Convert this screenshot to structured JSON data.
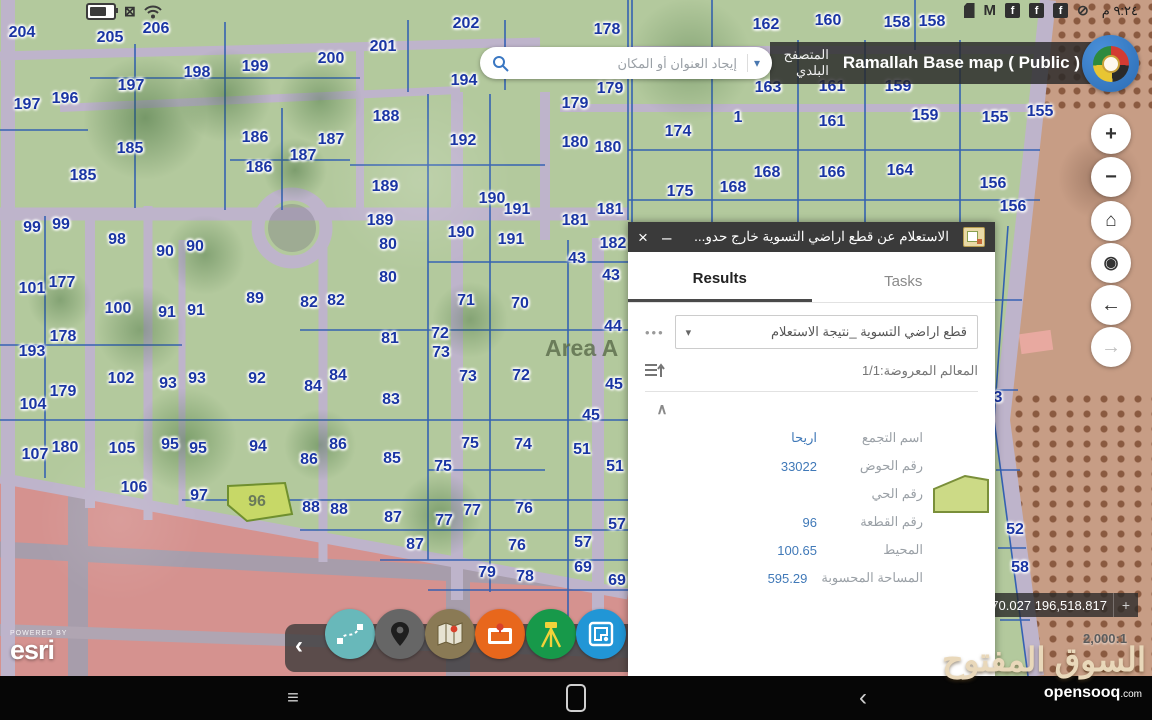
{
  "status_bar": {
    "time": "٩:٢٤ م",
    "gmail_glyph": "M",
    "facebook_glyph": "f",
    "mute_glyph": "⊘",
    "sim_glyph": "⊠"
  },
  "header": {
    "search_placeholder": "إيجاد العنوان أو المكان",
    "browser_label": "المتصفح البلدي",
    "map_title": "Ramallah Base map ( Public )"
  },
  "icons": {
    "close": "×",
    "minimize": "–",
    "overflow": "•••",
    "caret": "▾",
    "collapse": "∧",
    "toolbar_collapse": "‹",
    "zoom_in": "+",
    "zoom_out": "−",
    "home": "⌂",
    "locate": "◉",
    "back": "←",
    "forward": "→",
    "recents": "≡",
    "nav_back": "‹",
    "crosshair": "+"
  },
  "panel": {
    "title": "الاستعلام عن قطع اراضي التسوية خارج حدو...",
    "tabs": [
      {
        "label": "Results",
        "active": true
      },
      {
        "label": "Tasks",
        "active": false
      }
    ],
    "layer_select": "قطع اراضي التسوية _نتيجة الاستعلام",
    "features_shown": "المعالم المعروضة:1/1",
    "fields": [
      {
        "label": "اسم التجمع",
        "value": "اريحا"
      },
      {
        "label": "رقم الحوض",
        "value": "33022"
      },
      {
        "label": "رقم الحي",
        "value": ""
      },
      {
        "label": "رقم القطعة",
        "value": "96"
      },
      {
        "label": "المحيط",
        "value": "100.65"
      },
      {
        "label": "المساحة المحسوبة",
        "value": "595.29"
      }
    ]
  },
  "map": {
    "area_label": "Area A",
    "coordinates": ",470.027 196,518.817",
    "scale": "2,000:1",
    "powered_by": "POWERED BY",
    "esri_label": "esri",
    "highlighted_parcel": "96",
    "labels": [
      [
        "204",
        22,
        33
      ],
      [
        "205",
        110,
        38
      ],
      [
        "206",
        156,
        29
      ],
      [
        "201",
        383,
        47
      ],
      [
        "202",
        466,
        24
      ],
      [
        "200",
        331,
        59
      ],
      [
        "199",
        255,
        67
      ],
      [
        "198",
        197,
        73
      ],
      [
        "194",
        464,
        81
      ],
      [
        "197",
        131,
        86
      ],
      [
        "196",
        65,
        99
      ],
      [
        "197",
        27,
        105
      ],
      [
        "178",
        607,
        30
      ],
      [
        "162",
        766,
        25
      ],
      [
        "160",
        828,
        21
      ],
      [
        "158",
        897,
        23
      ],
      [
        "158",
        932,
        22
      ],
      [
        "179",
        610,
        89
      ],
      [
        "179",
        575,
        104
      ],
      [
        "163",
        768,
        88
      ],
      [
        "161",
        832,
        87
      ],
      [
        "159",
        898,
        87
      ],
      [
        "1",
        738,
        118
      ],
      [
        "161",
        832,
        122
      ],
      [
        "159",
        925,
        116
      ],
      [
        "155",
        995,
        118
      ],
      [
        "155",
        1040,
        112
      ],
      [
        "185",
        130,
        149
      ],
      [
        "185",
        83,
        176
      ],
      [
        "186",
        255,
        138
      ],
      [
        "187",
        331,
        140
      ],
      [
        "186",
        259,
        168
      ],
      [
        "187",
        303,
        156
      ],
      [
        "188",
        386,
        117
      ],
      [
        "189",
        385,
        187
      ],
      [
        "189",
        380,
        221
      ],
      [
        "192",
        463,
        141
      ],
      [
        "190",
        492,
        199
      ],
      [
        "191",
        517,
        210
      ],
      [
        "190",
        461,
        233
      ],
      [
        "191",
        511,
        240
      ],
      [
        "174",
        678,
        132
      ],
      [
        "180",
        575,
        143
      ],
      [
        "180",
        608,
        148
      ],
      [
        "175",
        680,
        192
      ],
      [
        "168",
        733,
        188
      ],
      [
        "168",
        767,
        173
      ],
      [
        "166",
        832,
        173
      ],
      [
        "164",
        900,
        171
      ],
      [
        "156",
        993,
        184
      ],
      [
        "156",
        1013,
        207
      ],
      [
        "181",
        610,
        210
      ],
      [
        "181",
        575,
        221
      ],
      [
        "182",
        613,
        244
      ],
      [
        "99",
        32,
        228
      ],
      [
        "99",
        61,
        225
      ],
      [
        "98",
        117,
        240
      ],
      [
        "90",
        165,
        252
      ],
      [
        "90",
        195,
        247
      ],
      [
        "80",
        388,
        245
      ],
      [
        "80",
        388,
        278
      ],
      [
        "101",
        32,
        289
      ],
      [
        "177",
        62,
        283
      ],
      [
        "100",
        118,
        309
      ],
      [
        "91",
        167,
        313
      ],
      [
        "91",
        196,
        311
      ],
      [
        "89",
        255,
        299
      ],
      [
        "82",
        309,
        303
      ],
      [
        "82",
        336,
        301
      ],
      [
        "71",
        466,
        301
      ],
      [
        "70",
        520,
        304
      ],
      [
        "43",
        577,
        259
      ],
      [
        "43",
        611,
        276
      ],
      [
        "178",
        63,
        337
      ],
      [
        "193",
        32,
        352
      ],
      [
        "81",
        390,
        339
      ],
      [
        "72",
        440,
        334
      ],
      [
        "73",
        441,
        353
      ],
      [
        "44",
        613,
        327
      ],
      [
        "102",
        121,
        379
      ],
      [
        "93",
        168,
        384
      ],
      [
        "93",
        197,
        379
      ],
      [
        "92",
        257,
        379
      ],
      [
        "84",
        313,
        387
      ],
      [
        "84",
        338,
        376
      ],
      [
        "83",
        391,
        400
      ],
      [
        "73",
        468,
        377
      ],
      [
        "72",
        521,
        376
      ],
      [
        "179",
        63,
        392
      ],
      [
        "104",
        33,
        405
      ],
      [
        "45",
        614,
        385
      ],
      [
        "45",
        591,
        416
      ],
      [
        "3",
        998,
        398
      ],
      [
        "107",
        35,
        455
      ],
      [
        "180",
        65,
        448
      ],
      [
        "105",
        122,
        449
      ],
      [
        "95",
        170,
        445
      ],
      [
        "95",
        198,
        449
      ],
      [
        "94",
        258,
        447
      ],
      [
        "86",
        309,
        460
      ],
      [
        "86",
        338,
        445
      ],
      [
        "85",
        392,
        459
      ],
      [
        "75",
        470,
        444
      ],
      [
        "75",
        443,
        467
      ],
      [
        "74",
        523,
        445
      ],
      [
        "51",
        582,
        450
      ],
      [
        "51",
        615,
        467
      ],
      [
        "106",
        134,
        488
      ],
      [
        "97",
        199,
        496
      ],
      [
        "96",
        257,
        502,
        1
      ],
      [
        "88",
        311,
        508
      ],
      [
        "88",
        339,
        510
      ],
      [
        "87",
        393,
        518
      ],
      [
        "77",
        472,
        511
      ],
      [
        "77",
        444,
        521
      ],
      [
        "76",
        524,
        509
      ],
      [
        "52",
        1015,
        530
      ],
      [
        "87",
        415,
        545
      ],
      [
        "76",
        517,
        546
      ],
      [
        "57",
        617,
        525
      ],
      [
        "57",
        583,
        543
      ],
      [
        "79",
        487,
        573
      ],
      [
        "78",
        525,
        577
      ],
      [
        "69",
        583,
        568
      ],
      [
        "69",
        617,
        581
      ],
      [
        "58",
        1020,
        568
      ]
    ]
  },
  "map_controls": [
    {
      "name": "zoom-in-button"
    },
    {
      "name": "zoom-out-button"
    },
    {
      "name": "home-button"
    },
    {
      "name": "locate-button"
    },
    {
      "name": "back-button"
    },
    {
      "name": "forward-button",
      "disabled": true
    }
  ],
  "toolbar": {
    "items": [
      {
        "name": "sketch-route-tool",
        "color": "#68b8ba"
      },
      {
        "name": "location-pin-tool",
        "color": "#666666"
      },
      {
        "name": "basemap-tool",
        "color": "#8a7a55"
      },
      {
        "name": "media-pin-tool",
        "color": "#e8671c"
      },
      {
        "name": "survey-tool",
        "color": "#17994a"
      },
      {
        "name": "parcel-map-tool",
        "color": "#2196d6"
      }
    ]
  },
  "watermark": {
    "arabic": "السوق المفتوح",
    "latin": "opensooq",
    "latin_suffix": ".com"
  },
  "colors": {
    "parcel_line": "#2e5db3",
    "parcel_number": "#1a35a3",
    "highlight_parcel_fill": "#c7d867",
    "road": "#beb4cb",
    "pink_zone": "#d5928f",
    "brown_zone": "#c79d85",
    "panel_header": "#3a3a3a",
    "value_blue": "#4079b8"
  }
}
